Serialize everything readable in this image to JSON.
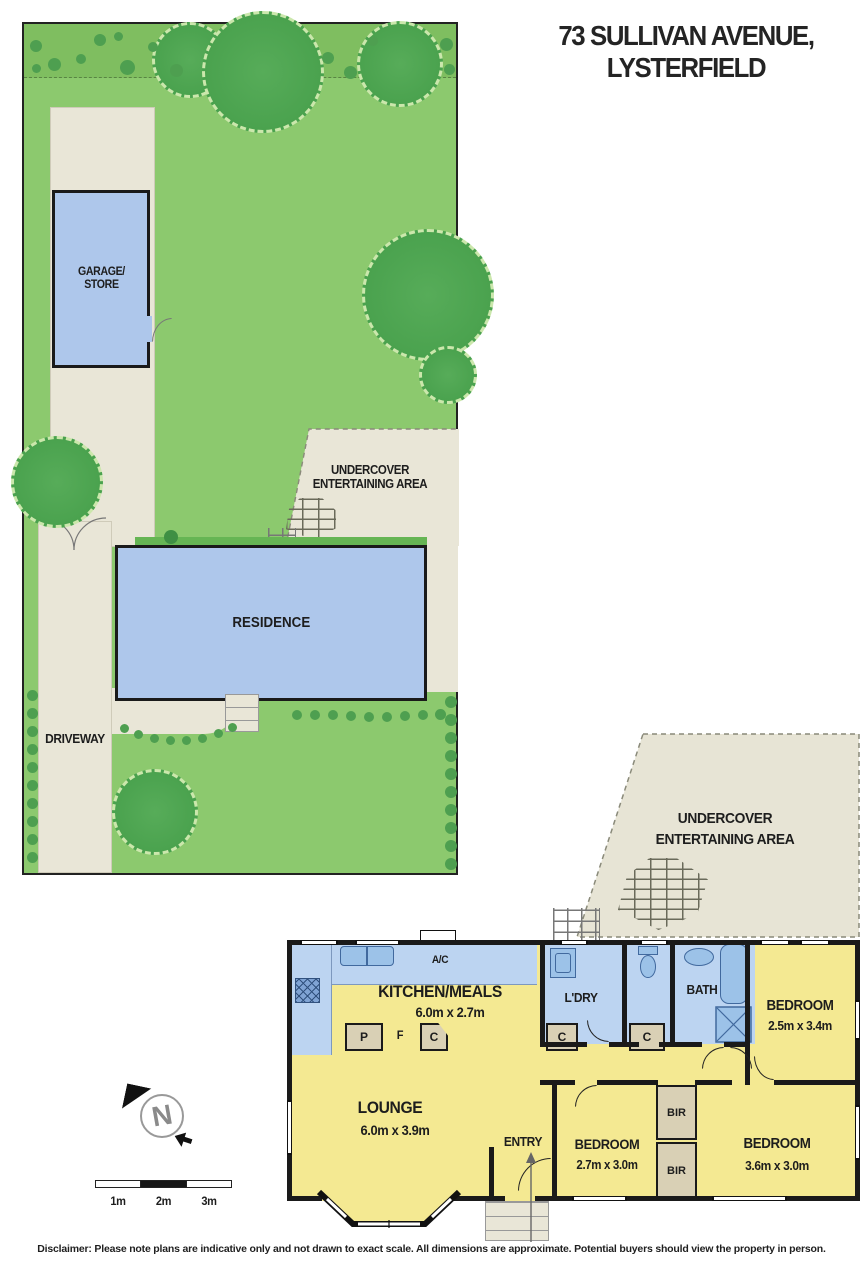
{
  "title": {
    "line1": "73 SULLIVAN AVENUE,",
    "line2": "LYSTERFIELD"
  },
  "site": {
    "garage": {
      "line1": "GARAGE/",
      "line2": "STORE"
    },
    "residence": "RESIDENCE",
    "driveway": "DRIVEWAY",
    "undercover": {
      "line1": "UNDERCOVER",
      "line2": "ENTERTAINING AREA"
    }
  },
  "plan": {
    "undercover": {
      "line1": "UNDERCOVER",
      "line2": "ENTERTAINING AREA"
    },
    "rooms": [
      {
        "name": "KITCHEN/MEALS",
        "dims": "6.0m x 2.7m"
      },
      {
        "name": "LOUNGE",
        "dims": "6.0m x 3.9m"
      },
      {
        "name": "L'DRY",
        "dims": ""
      },
      {
        "name": "BATH",
        "dims": ""
      },
      {
        "name": "ENTRY",
        "dims": ""
      },
      {
        "name": "BEDROOM",
        "dims": "2.5m x 3.4m"
      },
      {
        "name": "BEDROOM",
        "dims": "2.7m x 3.0m"
      },
      {
        "name": "BEDROOM",
        "dims": "3.6m x 3.0m"
      }
    ],
    "labels": {
      "ac": "A/C",
      "pantry": "P",
      "fridge": "F",
      "cupboard": "C",
      "robe": "BIR"
    }
  },
  "compass": {
    "north": "N"
  },
  "scale": {
    "labels": [
      "1m",
      "2m",
      "3m"
    ]
  },
  "disclaimer": "Disclaimer: Please note plans are indicative only and not drawn to exact scale. All dimensions are approximate. Potential buyers should view the property in person.",
  "colors": {
    "lawn": "#8CC96E",
    "lawnBand": "#7FBE60",
    "tree": "#4AA24E",
    "bush": "#4E9F50",
    "paving": "#E9E6D7",
    "building": "#AEC7EB",
    "wet": "#BCD4F1",
    "fixture": "#9CC2E8",
    "fixtureLine": "#41699E",
    "floor": "#F4E992",
    "cabinet": "#D9D0B5",
    "wall": "#1A1A1A",
    "dash": "#8A8A7A",
    "ink": "#1D1D1D"
  }
}
